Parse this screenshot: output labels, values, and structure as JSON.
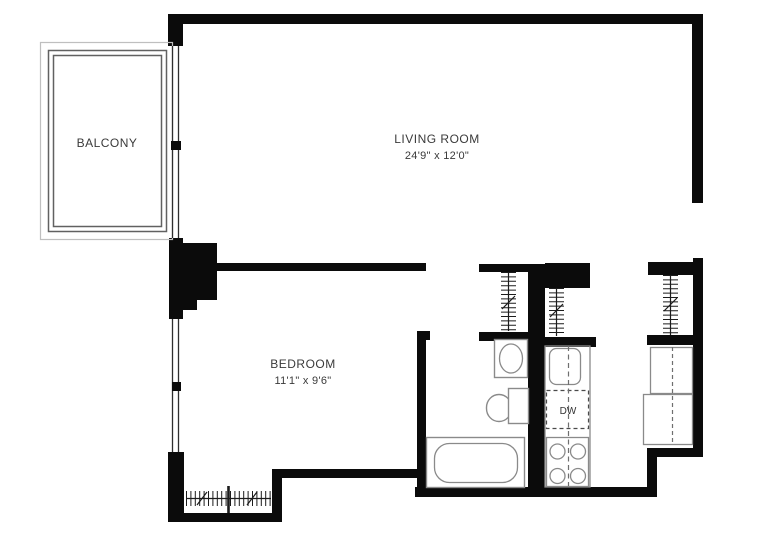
{
  "floorplan": {
    "balcony": {
      "label": "BALCONY"
    },
    "living_room": {
      "label": "LIVING ROOM",
      "dimensions": "24'9\" x 12'0\""
    },
    "bedroom": {
      "label": "BEDROOM",
      "dimensions": "11'1\" x 9'6\""
    },
    "kitchen": {
      "dishwasher_label": "DW"
    },
    "fixture_icons": [
      "toilet-icon",
      "pedestal-sink-icon",
      "bathtub-icon",
      "kitchen-sink-icon",
      "dishwasher-icon",
      "stove-burners-icon",
      "refrigerator-icon",
      "hanging-rod-icon",
      "window-wall-icon",
      "balcony-railing-icon"
    ],
    "colors": {
      "walls": "#0b0b0b",
      "fixture_outline": "#8a8a8a",
      "text": "#3a3a3a",
      "balcony_outer": "#bfbfbf",
      "railing": "#616161",
      "background": "#ffffff"
    }
  }
}
